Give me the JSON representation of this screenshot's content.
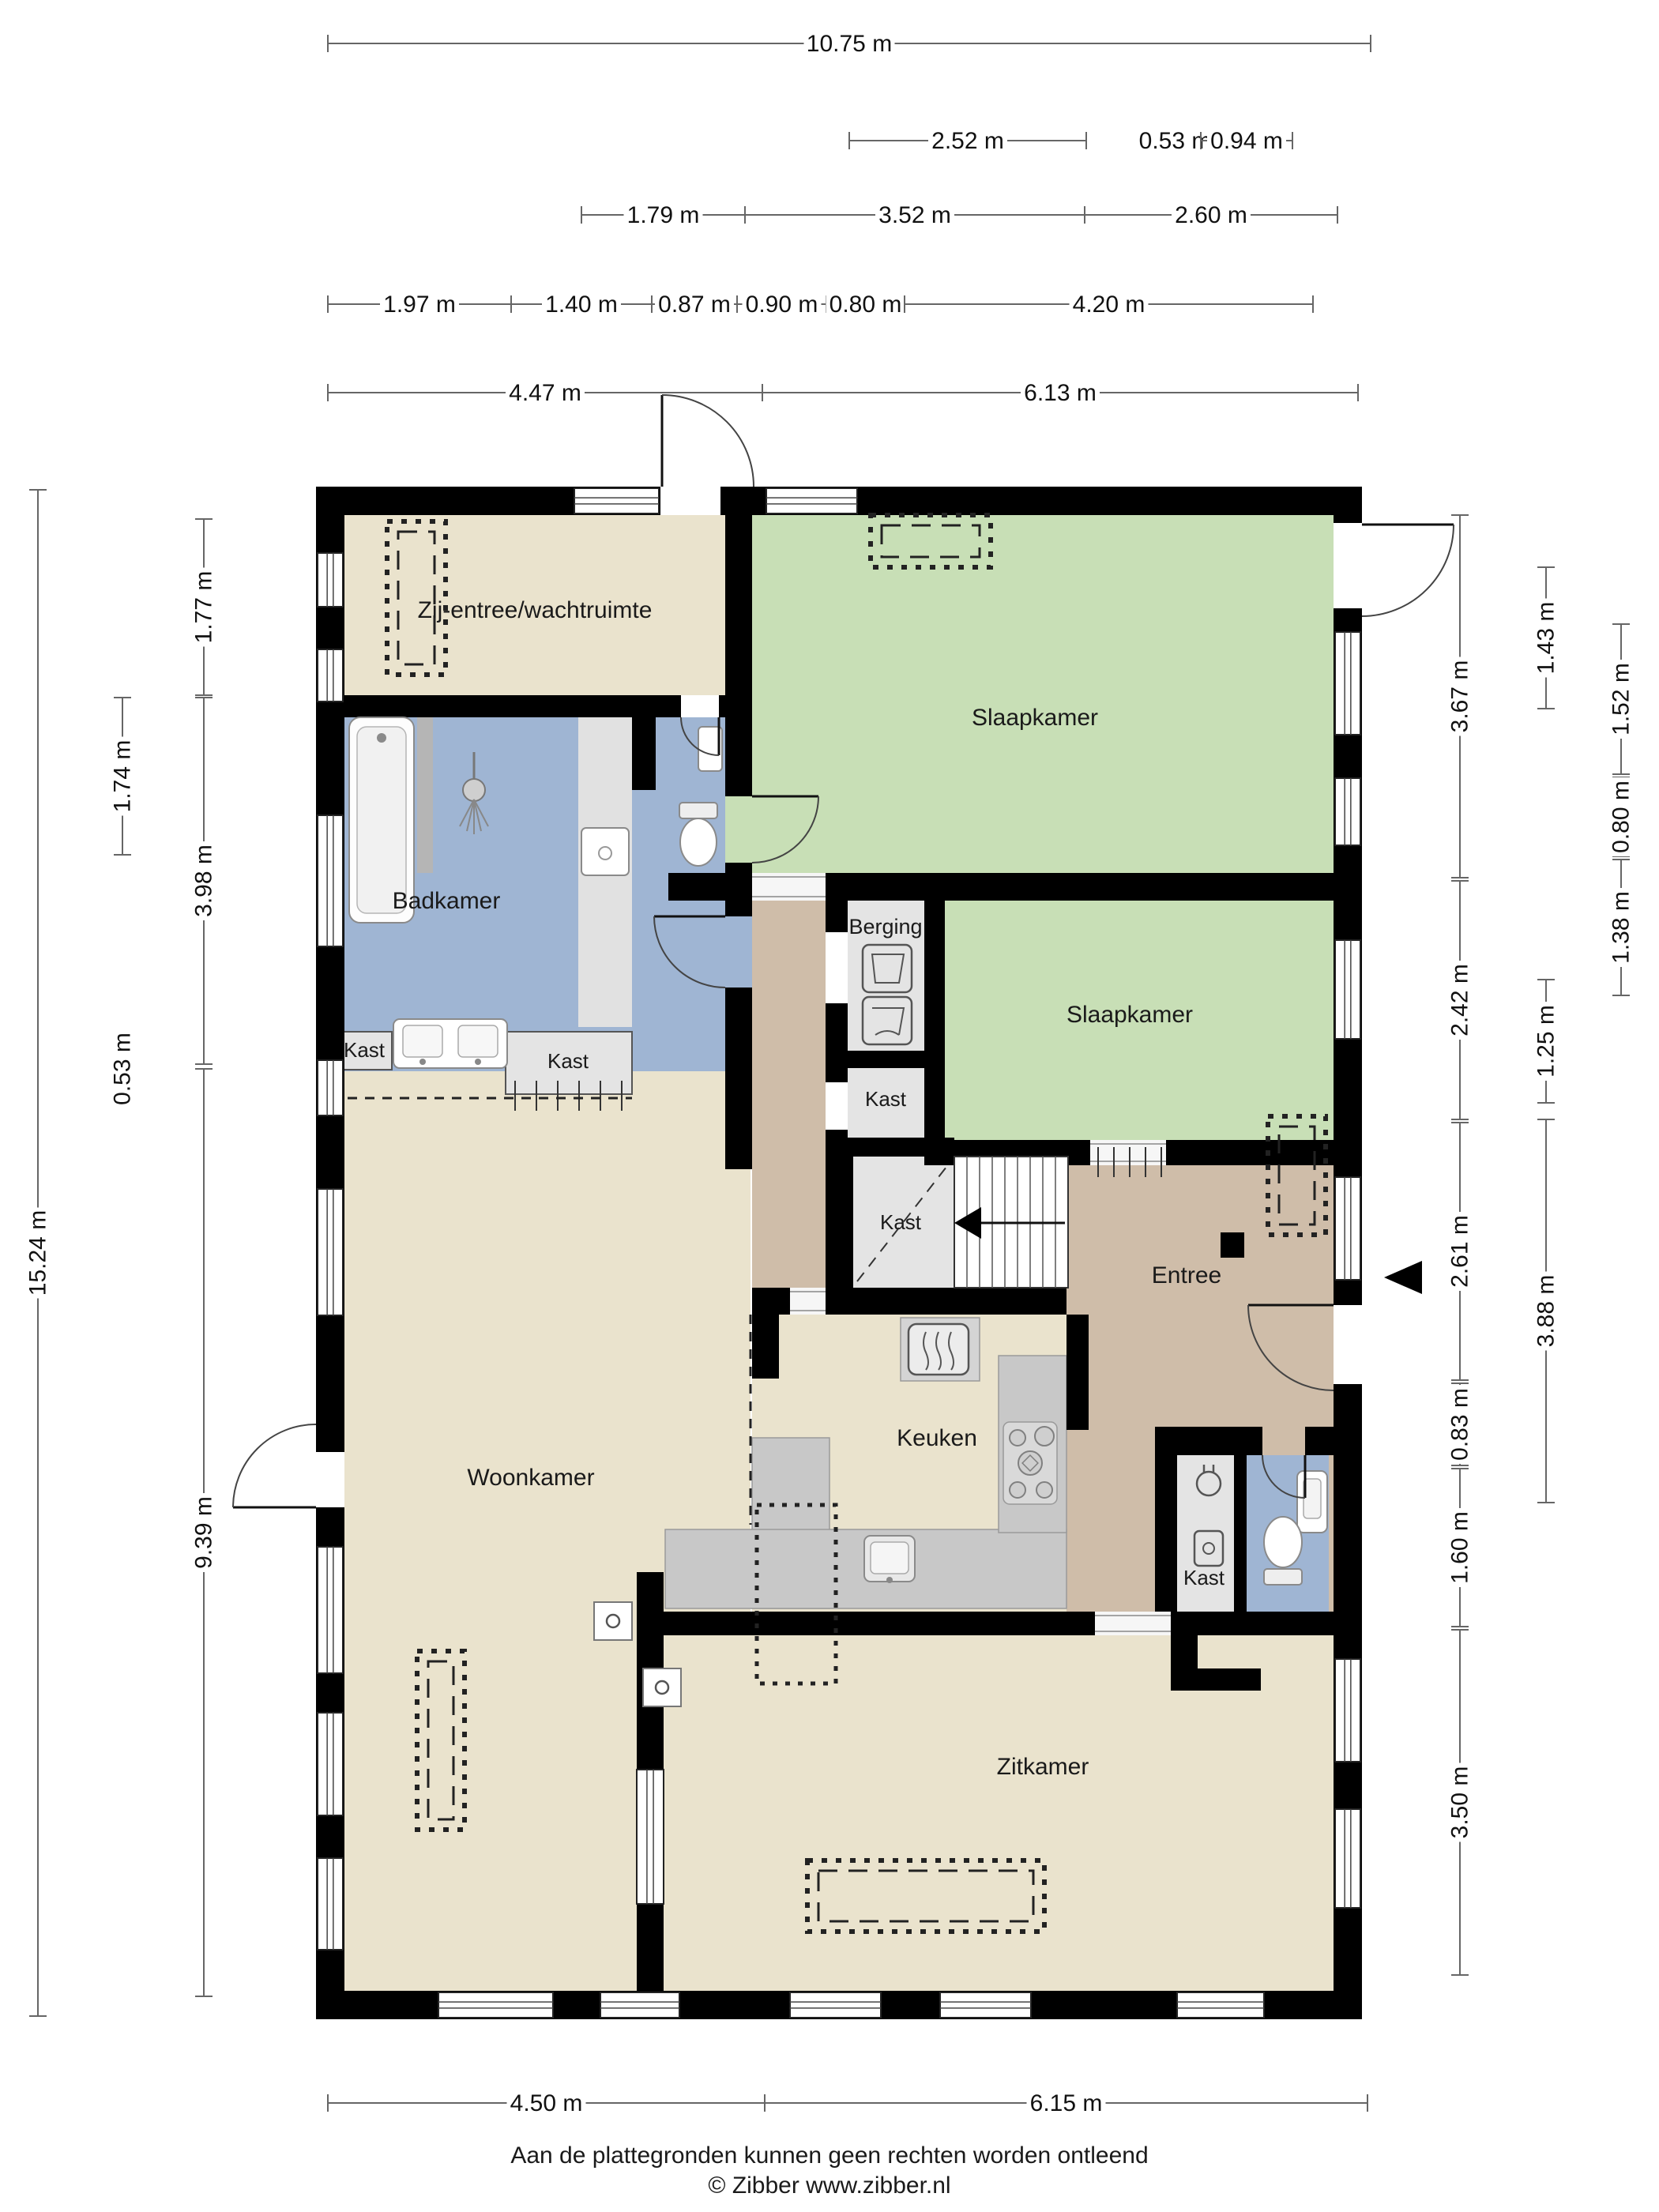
{
  "title": "Plattegrond begane grond",
  "footer": {
    "line1": "Aan de plattegronden kunnen geen rechten worden ontleend",
    "line2": "© Zibber www.zibber.nl"
  },
  "rooms": [
    {
      "id": "zij-entree",
      "label": "Zij-entree/wachtruimte"
    },
    {
      "id": "slaapkamer-1",
      "label": "Slaapkamer"
    },
    {
      "id": "badkamer",
      "label": "Badkamer"
    },
    {
      "id": "berging",
      "label": "Berging"
    },
    {
      "id": "slaapkamer-2",
      "label": "Slaapkamer"
    },
    {
      "id": "kast-bad-l",
      "label": "Kast"
    },
    {
      "id": "kast-bad-r",
      "label": "Kast"
    },
    {
      "id": "kast-center",
      "label": "Kast"
    },
    {
      "id": "kast-stairs",
      "label": "Kast"
    },
    {
      "id": "entree",
      "label": "Entree"
    },
    {
      "id": "keuken",
      "label": "Keuken"
    },
    {
      "id": "kast-meter",
      "label": "Kast"
    },
    {
      "id": "woonkamer",
      "label": "Woonkamer"
    },
    {
      "id": "zitkamer",
      "label": "Zitkamer"
    }
  ],
  "dimensions": {
    "horizontal": [
      "10.75 m",
      "2.52 m",
      "0.53 m",
      "0.94 m",
      "1.79 m",
      "3.52 m",
      "2.60 m",
      "1.97 m",
      "1.40 m",
      "0.87 m",
      "0.90 m",
      "0.80 m",
      "4.20 m",
      "4.47 m",
      "6.13 m",
      "4.50 m",
      "6.15 m"
    ],
    "vertical": [
      "15.24 m",
      "1.74 m",
      "0.53 m",
      "1.77 m",
      "3.98 m",
      "9.39 m",
      "3.67 m",
      "2.42 m",
      "2.61 m",
      "0.83 m",
      "1.60 m",
      "3.50 m",
      "1.43 m",
      "1.25 m",
      "3.88 m",
      "1.52 m",
      "0.80 m",
      "1.38 m"
    ]
  },
  "icons": [
    "washer-icon",
    "dryer-icon",
    "boiler-icon",
    "shower-icon",
    "bathtub-icon",
    "double-sink-icon",
    "washbasin-icon",
    "toilet-icon",
    "hob-icon",
    "kitchen-sink-icon",
    "electric-meter-icon",
    "stairs-up-arrow-icon",
    "entrance-arrow-icon"
  ],
  "colors": {
    "wall": "#000000",
    "floor_beige": "#eae3cd",
    "floor_green": "#c8dfb6",
    "floor_blue": "#9fb5d3",
    "floor_tan": "#cfbda9",
    "floor_gray": "#e4e4e4",
    "counter_gray": "#c8c8c8",
    "dim_line": "#666666",
    "dim_text": "#111111"
  }
}
